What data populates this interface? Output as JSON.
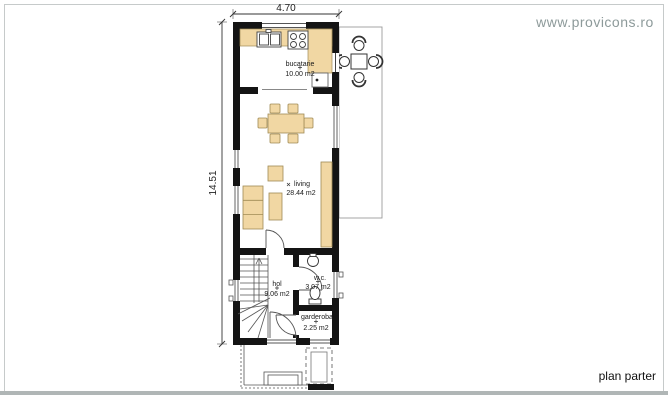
{
  "branding": {
    "website": "www.provicons.ro"
  },
  "plan": {
    "title": "plan parter",
    "dimensions": {
      "width_m": "4.70",
      "height_m": "14.51"
    },
    "rooms": [
      {
        "id": "bucatarie",
        "name": "bucatarie",
        "area": "10.00 m2"
      },
      {
        "id": "living",
        "name": "living",
        "area": "28.44 m2"
      },
      {
        "id": "hol",
        "name": "hol",
        "area": "9.06 m2"
      },
      {
        "id": "wc",
        "name": "w.c.",
        "area": "3.07 m2"
      },
      {
        "id": "garderoba",
        "name": "garderoba",
        "area": "2.25 m2"
      }
    ]
  },
  "colors": {
    "wall": "#141414",
    "furniture": "#f1d7a3",
    "furniture_outline": "#a08b55",
    "terrace_outline": "#9b9b9b",
    "dimension_line": "#333333",
    "website_text": "#8d9a9a",
    "frame_border": "#c6caca",
    "frame_bottom": "#b0b6b6"
  }
}
